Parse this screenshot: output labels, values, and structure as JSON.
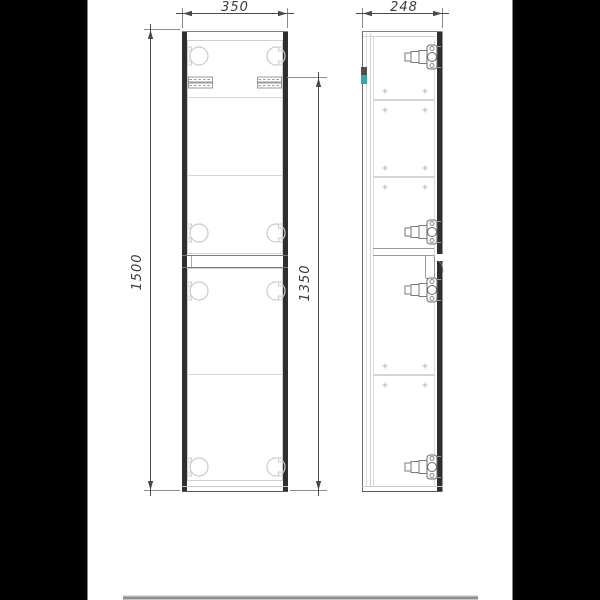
{
  "drawing": {
    "kind": "tall-cabinet-two-views",
    "dimensions": {
      "front_width": "350",
      "side_depth": "248",
      "total_height": "1500",
      "partial_height": "1350"
    }
  },
  "colors": {
    "background": "#000000",
    "paper": "#ffffff",
    "accent_teal": "#2fa9ad",
    "panel_dark": "#2f2f2f",
    "line_dark": "#4a4a4a",
    "line_mid": "#8a8a8a",
    "line_light": "#cfcfcf",
    "footer_bar": "#8f8f8f"
  }
}
